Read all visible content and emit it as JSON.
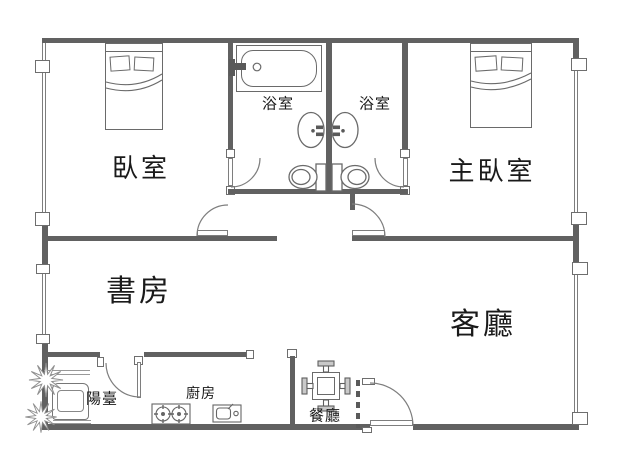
{
  "title": "apartment floor plan",
  "rooms": {
    "bedroom": "臥室",
    "master_bedroom": "主臥室",
    "bathroom_left": "浴室",
    "bathroom_right": "浴室",
    "study": "書房",
    "living_room": "客廳",
    "balcony": "陽臺",
    "kitchen": "廚房",
    "dining_room": "餐廳"
  },
  "fixtures": [
    "double-bed",
    "double-bed",
    "bathtub",
    "washbasin",
    "washbasin",
    "toilet",
    "toilet",
    "washing-machine",
    "plant",
    "gas-stove",
    "kitchen-sink",
    "dining-table",
    "dining-chairs",
    "entry-door",
    "room-doors",
    "windows"
  ],
  "colors": {
    "wall": "#616161",
    "line": "#7e7e7e",
    "text": "#1a1a1a",
    "background": "#ffffff"
  }
}
